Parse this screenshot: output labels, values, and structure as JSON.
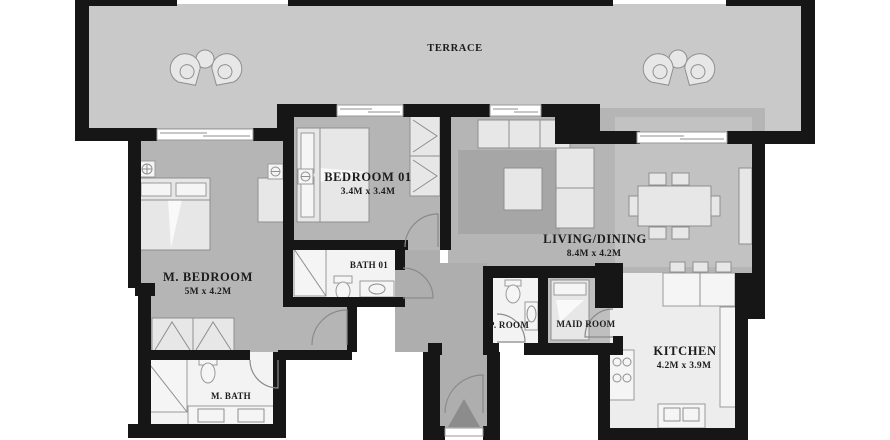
{
  "palette": {
    "wall": "#161616",
    "terrace_floor": "#c9c9c9",
    "room_floor": "#b5b5b5",
    "corridor_floor": "#aeaeae",
    "wet_room_floor": "#f3f3f3",
    "kitchen_floor": "#ededed",
    "furniture": "#e7e7e7",
    "rug": "#a6a6a6",
    "label_text": "#1c1c1c",
    "background": "#ffffff"
  },
  "rooms": {
    "terrace": {
      "label": "TERRACE"
    },
    "bedroom01": {
      "label": "BEDROOM 01",
      "dimensions": "3.4M x 3.4M"
    },
    "m_bedroom": {
      "label": "M. BEDROOM",
      "dimensions": "5M x 4.2M"
    },
    "bath01": {
      "label": "BATH 01"
    },
    "living_dining": {
      "label": "LIVING/DINING",
      "dimensions": "8.4M x 4.2M"
    },
    "p_room": {
      "label": "P. ROOM"
    },
    "maid_room": {
      "label": "MAID ROOM"
    },
    "kitchen": {
      "label": "KITCHEN",
      "dimensions": "4.2M x 3.9M"
    },
    "m_bath": {
      "label": "M. BATH"
    }
  }
}
